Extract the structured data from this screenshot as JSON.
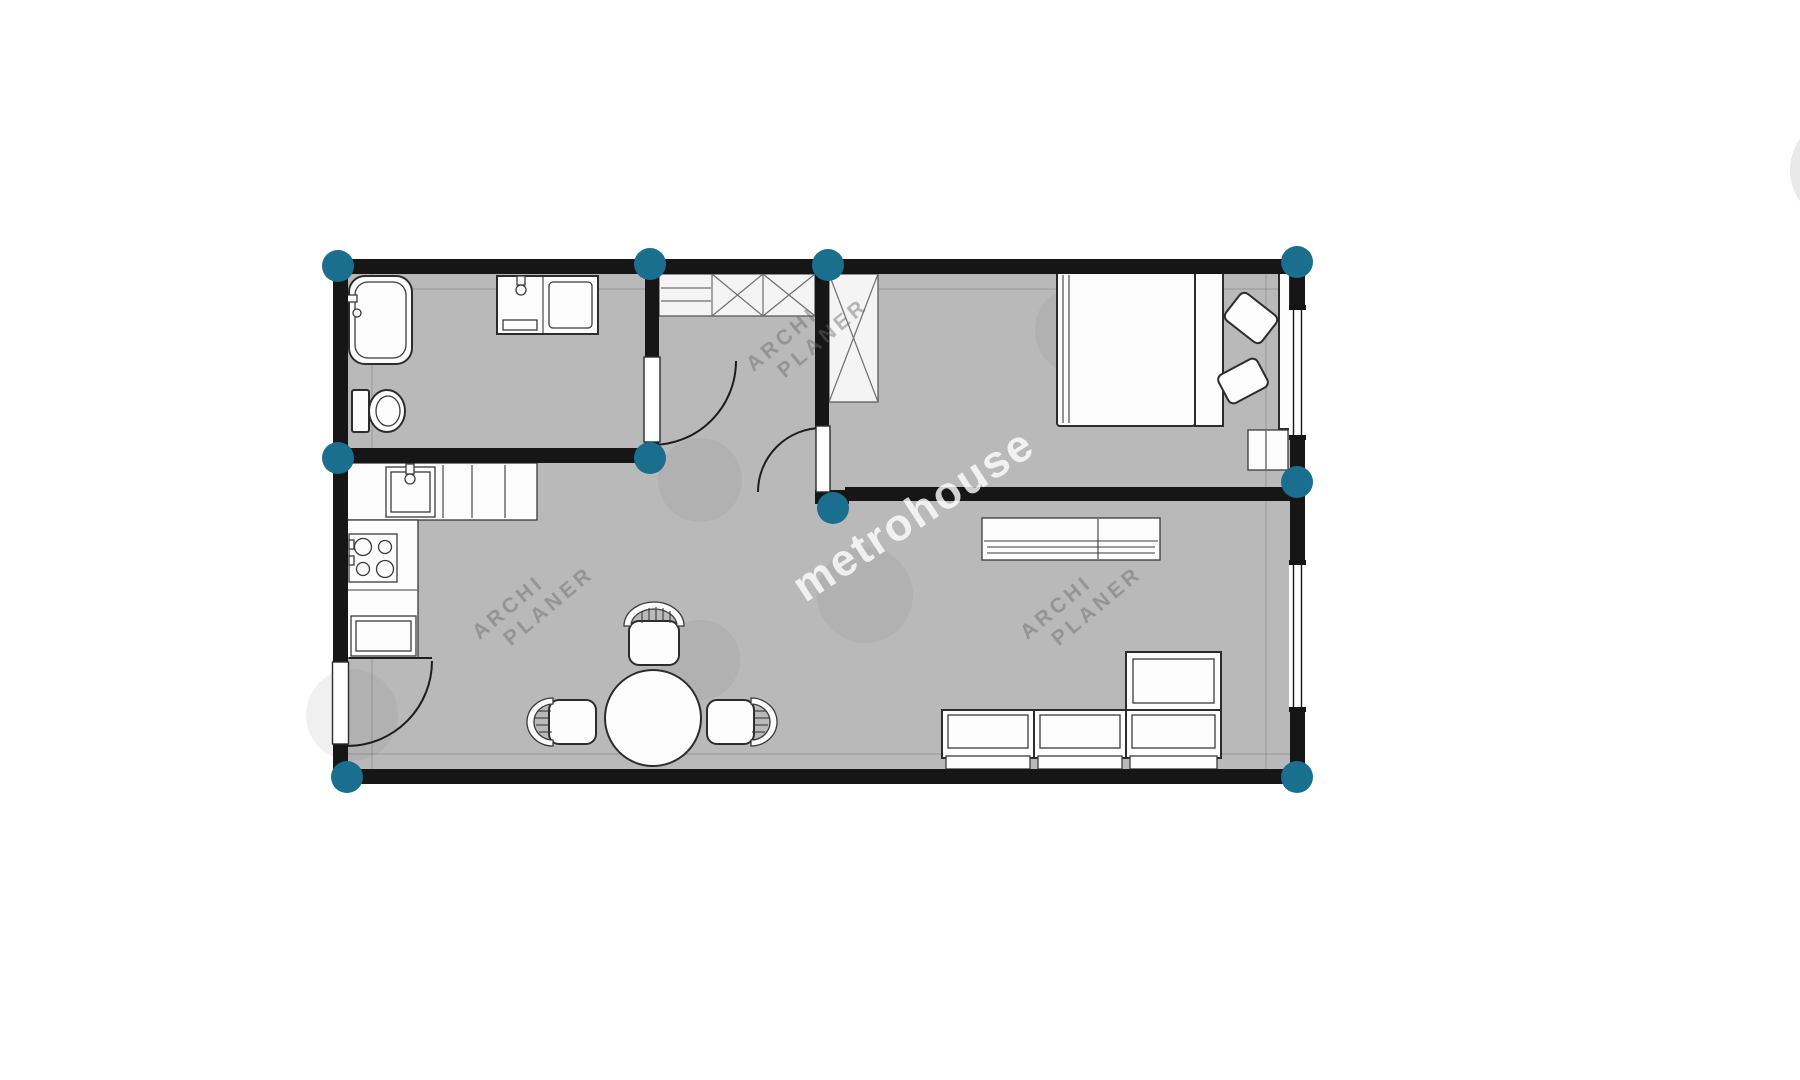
{
  "watermarks": {
    "brand": "metrohouse",
    "planner_line1": "ARCHI",
    "planner_line2": "PLANER"
  },
  "colors": {
    "marker": "#1a6e8e",
    "wall": "#161616",
    "floor": "#b9b9b9",
    "page": "#ffffff",
    "edge_circle": "#e9e9e9"
  },
  "markers": [
    {
      "x": 338,
      "y": 266
    },
    {
      "x": 650,
      "y": 264
    },
    {
      "x": 828,
      "y": 265
    },
    {
      "x": 1297,
      "y": 262
    },
    {
      "x": 338,
      "y": 458
    },
    {
      "x": 650,
      "y": 458
    },
    {
      "x": 833,
      "y": 508
    },
    {
      "x": 1297,
      "y": 482
    },
    {
      "x": 347,
      "y": 777
    },
    {
      "x": 1297,
      "y": 777
    }
  ]
}
